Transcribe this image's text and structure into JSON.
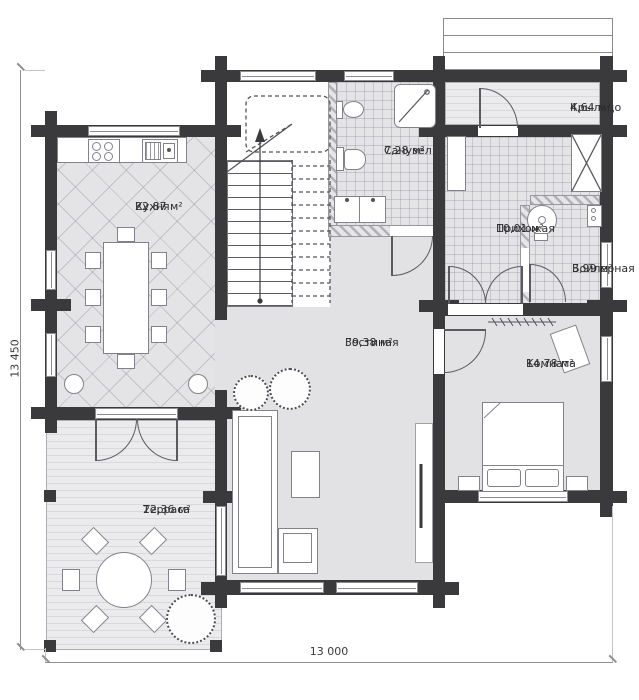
{
  "rooms": [
    {
      "id": "kitchen",
      "name": "Кухня",
      "area": "22,87 м²"
    },
    {
      "id": "bathroom",
      "name": "Санузел",
      "area": "7,28 м²"
    },
    {
      "id": "porch",
      "name": "Крыльцо",
      "area": "4,64 м²"
    },
    {
      "id": "hallway",
      "name": "Прихожая",
      "area": "10,01 м²"
    },
    {
      "id": "boiler",
      "name": "Бойлерная",
      "area": "3,99 м²"
    },
    {
      "id": "living",
      "name": "Гостиная",
      "area": "39,38 м²"
    },
    {
      "id": "room",
      "name": "Комната",
      "area": "14,78 м²"
    },
    {
      "id": "terrace",
      "name": "Терраса",
      "area": "22,36 м²"
    }
  ],
  "dimensions": {
    "left": "13 450",
    "bottom": "13 000"
  },
  "colors": {
    "wall": "#3a3a3c",
    "floor": "#e3e3e6",
    "text": "#2e2e31"
  }
}
